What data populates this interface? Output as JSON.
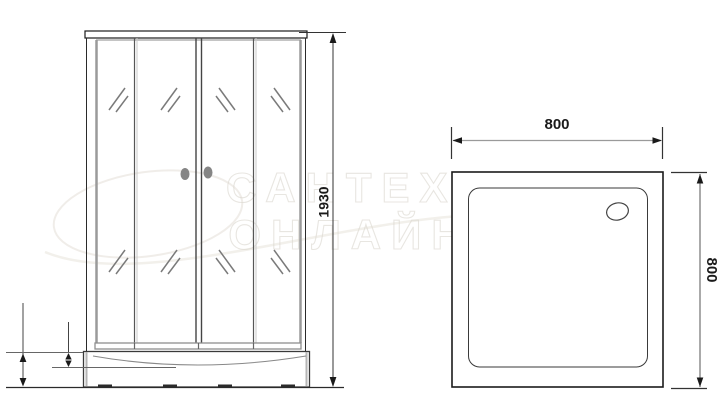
{
  "watermark": {
    "line1": "САНТЕХНИКА",
    "line2": "ОНЛАЙН"
  },
  "front_view": {
    "height_label": "1930"
  },
  "top_view": {
    "width_label": "800",
    "depth_label": "800"
  },
  "colors": {
    "line": "#1a1a1a",
    "frame_gray": "#9a9a9a",
    "glass_mark": "#7a7a7a",
    "handle": "#858585",
    "watermark": "#dad6ce",
    "background": "#ffffff"
  }
}
